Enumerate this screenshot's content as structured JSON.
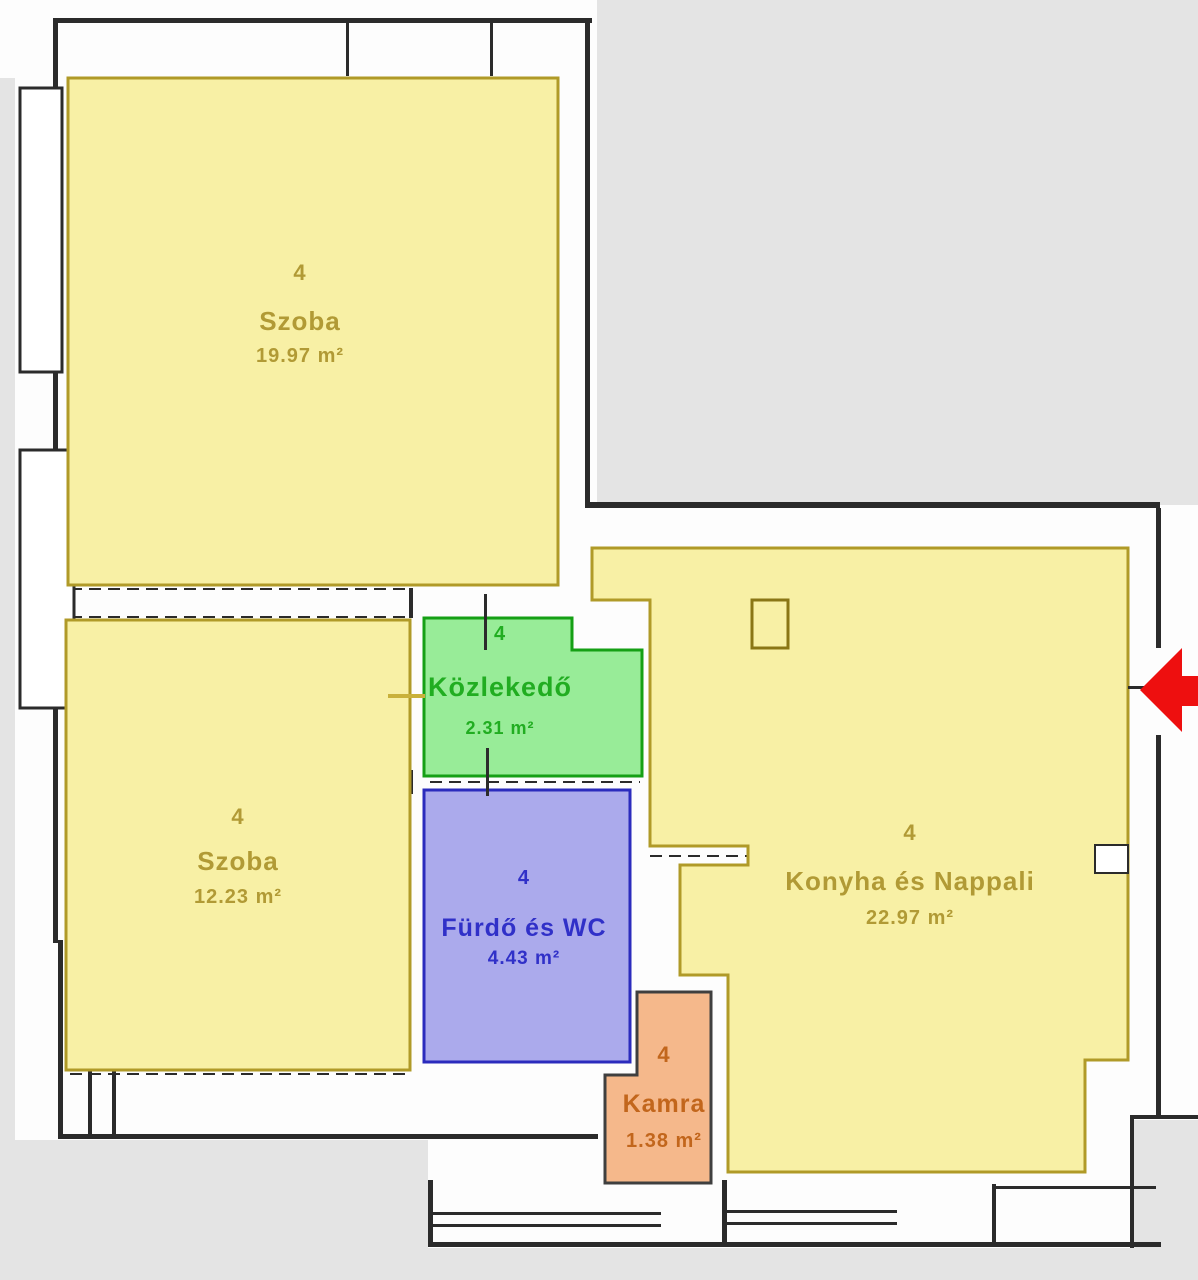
{
  "floor_plan": {
    "rooms": [
      {
        "number": "4",
        "name": "Szoba",
        "area": "19.97 m²"
      },
      {
        "number": "4",
        "name": "Szoba",
        "area": "12.23 m²"
      },
      {
        "number": "4",
        "name": "Közlekedő",
        "area": "2.31 m²"
      },
      {
        "number": "4",
        "name": "Fürdő és WC",
        "area": "4.43 m²"
      },
      {
        "number": "4",
        "name": "Kamra",
        "area": "1.38 m²"
      },
      {
        "number": "4",
        "name": "Konyha és Nappali",
        "area": "22.97 m²"
      }
    ],
    "colors": {
      "room_fill_yellow": "#f8f0a5",
      "room_stroke_yellow": "#b09a28",
      "room_text_yellow": "#b19a35",
      "room_fill_green": "#98ec98",
      "room_stroke_green": "#15a015",
      "room_text_green": "#21ad21",
      "room_fill_blue": "#abaaec",
      "room_stroke_blue": "#2b2bbd",
      "room_text_blue": "#3030c8",
      "room_fill_orange": "#f5b88b",
      "room_stroke_orange": "#3f3f3f",
      "room_text_orange": "#c2661c",
      "outside_gray": "#e4e4e4",
      "wall_black": "#2b2b2b",
      "accent_yellow_dash": "#c9b13b",
      "entrance_arrow_red": "#ee0f0f"
    }
  }
}
